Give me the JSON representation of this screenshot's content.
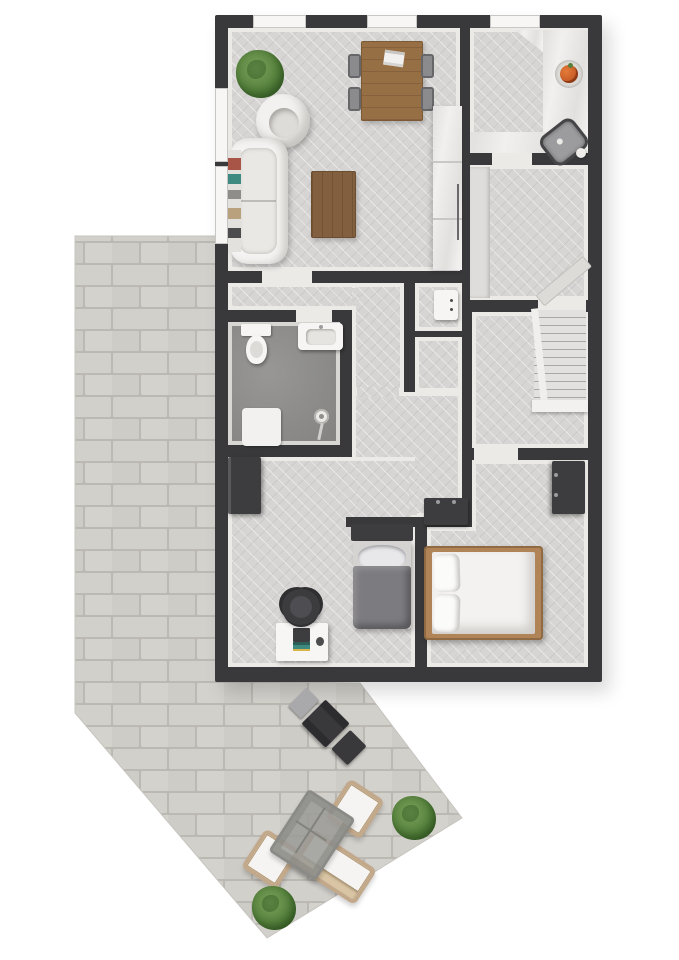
{
  "scene": {
    "type": "3d-rendered-floor-plan-top-view",
    "background": "#ffffff",
    "building_storeys_visible": 1,
    "has_outdoor_patio": true
  },
  "palette": {
    "wall": "#39393b",
    "floor_herringbone": "#d7d5d3",
    "floor_trim": "#eceae7",
    "bathroom_concrete": "#8f8e8c",
    "counter_marble": "#f1f0ee",
    "wood_table": "#976f45",
    "wood_coffee_table": "#82603f",
    "wood_bed_frame": "#b08457",
    "dark_furniture": "#3d3d40",
    "white_furniture": "#f4f3f1",
    "gray_textile": "#7c7b7f",
    "chair_gray": "#8b8b8d",
    "patio_brick": "#d2d0cb",
    "patio_mortar": "#bcb9b3",
    "plant_green": "#55803c",
    "fruit_orange": "#cf5c28",
    "wicker_tan": "#c3a98b"
  },
  "rooms": [
    {
      "name": "living-dining-room",
      "floor": "herringbone",
      "furniture": [
        "potted-plant",
        "round-armchair",
        "sofa",
        "bookshelf",
        "coffee-table",
        "dining-table",
        "magazine",
        "dining-chair",
        "dining-chair",
        "dining-chair",
        "dining-chair",
        "tall-cabinet"
      ],
      "dining_chair_count": 4,
      "window_count": 3
    },
    {
      "name": "kitchen",
      "floor": "herringbone",
      "furniture": [
        "l-shaped-counter",
        "corner-counter",
        "fruit-bowl",
        "sink"
      ],
      "window_count": 1
    },
    {
      "name": "room-below-kitchen",
      "floor": "herringbone",
      "furniture": [
        "side-counter",
        "open-door-leaf"
      ]
    },
    {
      "name": "hallway",
      "floor": "herringbone",
      "furniture": []
    },
    {
      "name": "utility-closet-upper",
      "floor": "herringbone",
      "furniture": [
        "boiler-unit"
      ]
    },
    {
      "name": "utility-closet-lower",
      "floor": "herringbone",
      "furniture": []
    },
    {
      "name": "bathroom",
      "floor": "concrete",
      "furniture": [
        "toilet",
        "wall-hung-sink",
        "shower-mat",
        "shower-head"
      ]
    },
    {
      "name": "stair-hall",
      "floor": "herringbone",
      "furniture": [
        "staircase"
      ],
      "stair_tread_count": 12
    },
    {
      "name": "corridor",
      "floor": "herringbone",
      "furniture": [
        "low-cabinet"
      ]
    },
    {
      "name": "bedroom-small",
      "floor": "herringbone",
      "furniture": [
        "wardrobe",
        "single-bed",
        "gray-duvet",
        "pillow",
        "desk",
        "laptop",
        "mouse",
        "desk-chair"
      ]
    },
    {
      "name": "bedroom-master",
      "floor": "herringbone",
      "furniture": [
        "double-bed",
        "pillow",
        "pillow",
        "wardrobe"
      ],
      "pillow_count": 2
    }
  ],
  "outdoor": {
    "surface": "brick-paver-patio",
    "items": [
      "bbq-grill",
      "grill-side-shelf",
      "outdoor-lounge-chair",
      "outdoor-lounge-chair",
      "outdoor-sofa",
      "outdoor-coffee-table",
      "potted-plant",
      "potted-plant",
      "potted-plant"
    ],
    "plant_count": 3,
    "chair_count": 2
  }
}
